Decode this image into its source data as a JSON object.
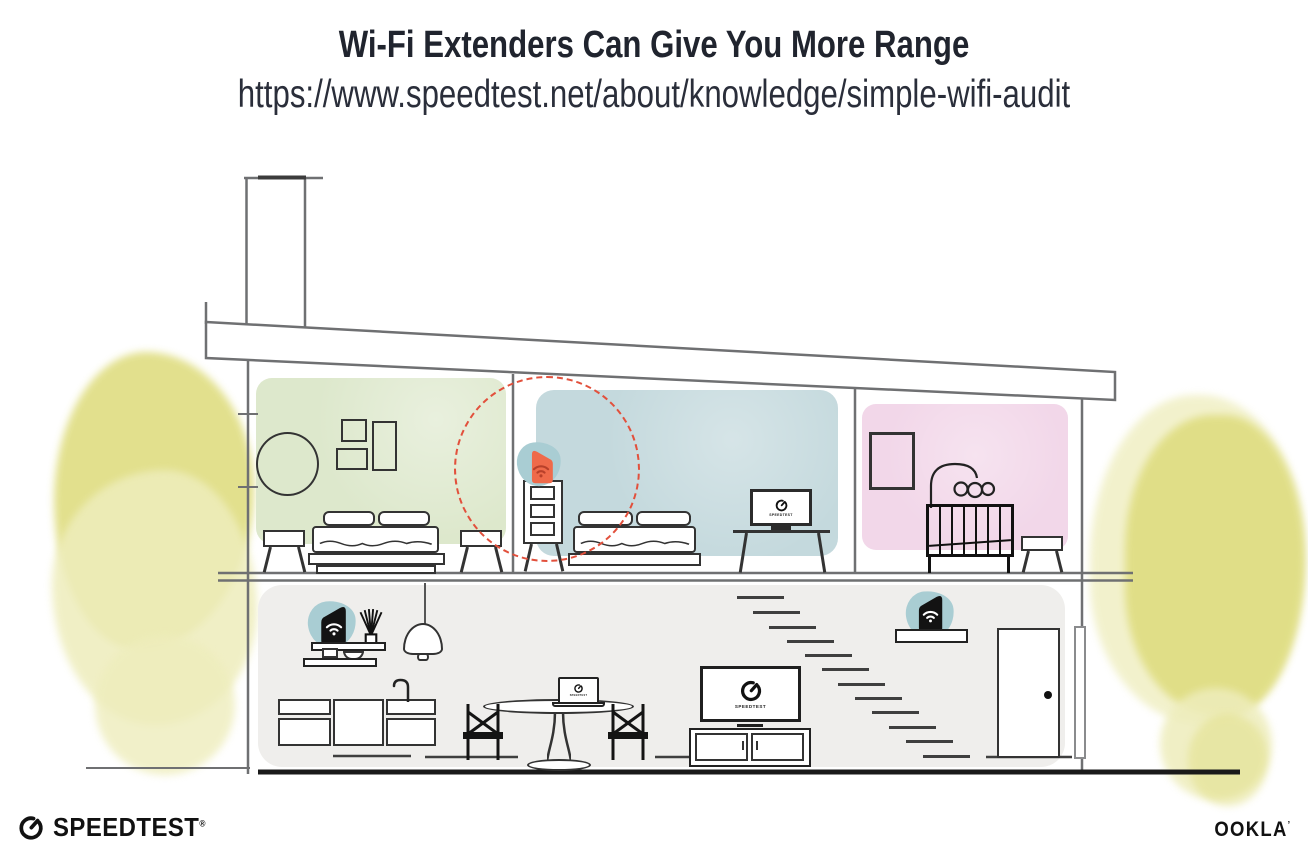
{
  "header": {
    "title": "Wi-Fi Extenders Can Give You More Range",
    "url": "https://www.speedtest.net/about/knowledge/simple-wifi-audit"
  },
  "screens": {
    "bedroom_tv_label": "SPEEDTEST",
    "living_tv_label": "SPEEDTEST",
    "laptop_label": "SPEEDTEST"
  },
  "branding": {
    "speedtest_wordmark": "SPEEDTEST",
    "speedtest_trademark": "®",
    "ookla_wordmark": "OOKLA",
    "ookla_trademark": "’"
  },
  "icons": {
    "wifi": "wifi-icon",
    "speedtest_gauge": "gauge-icon"
  },
  "colors": {
    "room-green": "#dde8cc",
    "room-blue": "#c4d9dd",
    "room-pink": "#f2d7e9",
    "floor-gray": "#efeeec",
    "device-teal": "#a9cdd3",
    "extender-orange": "#ef6a4a",
    "extender-wifi": "#b8402a",
    "range-ring": "#e2503c",
    "foliage": "#e0de84",
    "foliage-light": "#eeedbc",
    "wall-line": "#6f7072",
    "title-ink": "#20242e"
  }
}
